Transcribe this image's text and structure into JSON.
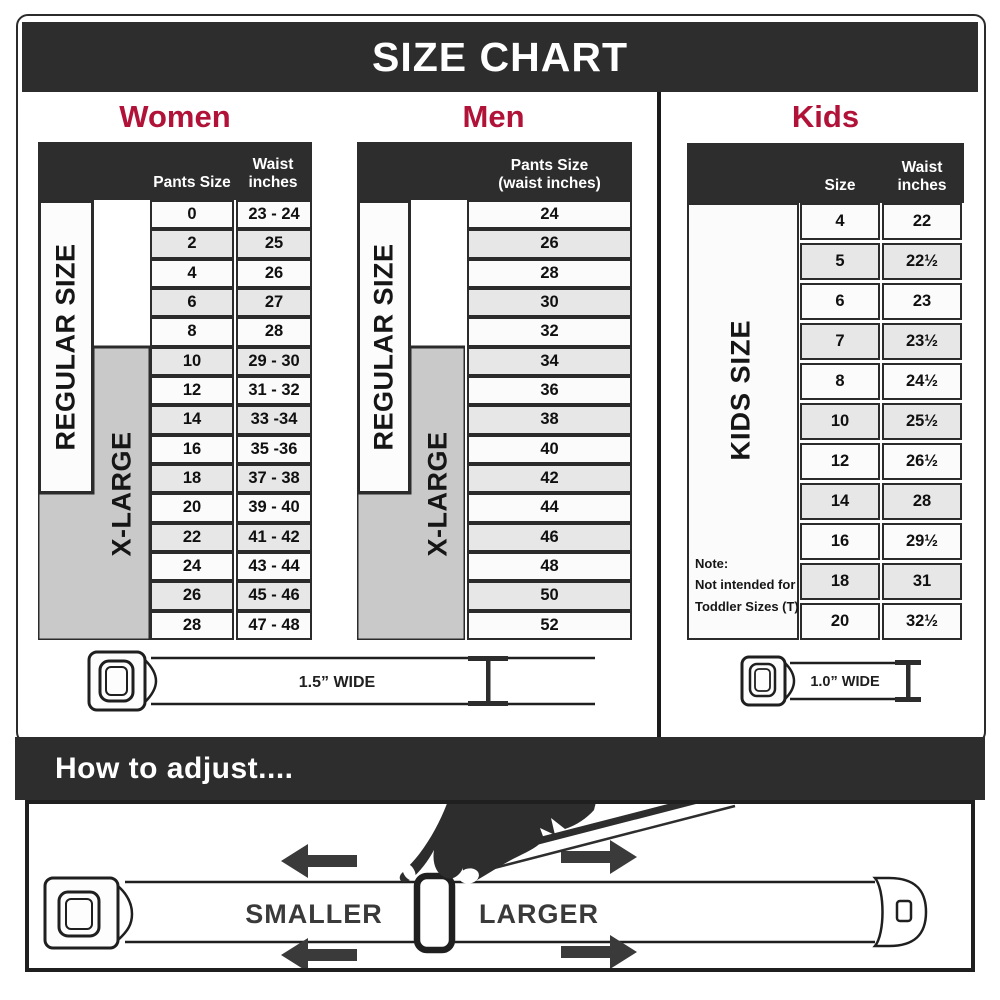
{
  "title": "SIZE CHART",
  "colors": {
    "banner_dark": "#2d2d2d",
    "accent_red": "#b11238",
    "row_shade": "#e7e7e7",
    "xlarge_gray": "#c9c9c9"
  },
  "women": {
    "heading": "Women",
    "col1_header": "Pants Size",
    "col2_header_line1": "Waist",
    "col2_header_line2": "inches",
    "regular_label": "REGULAR SIZE",
    "xlarge_label": "X-LARGE",
    "pants_sizes": [
      "0",
      "2",
      "4",
      "6",
      "8",
      "10",
      "12",
      "14",
      "16",
      "18",
      "20",
      "22",
      "24",
      "26",
      "28"
    ],
    "waist_inches": [
      "23 - 24",
      "25",
      "26",
      "27",
      "28",
      "29 - 30",
      "31 - 32",
      "33 -34",
      "35 -36",
      "37 - 38",
      "39 - 40",
      "41 - 42",
      "43 - 44",
      "45 - 46",
      "47 - 48"
    ],
    "belt_width_label": "1.5” WIDE"
  },
  "men": {
    "heading": "Men",
    "col_header_line1": "Pants Size",
    "col_header_line2": "(waist inches)",
    "regular_label": "REGULAR SIZE",
    "xlarge_label": "X-LARGE",
    "sizes": [
      "24",
      "26",
      "28",
      "30",
      "32",
      "34",
      "36",
      "38",
      "40",
      "42",
      "44",
      "46",
      "48",
      "50",
      "52"
    ]
  },
  "kids": {
    "heading": "Kids",
    "col1_header": "Size",
    "col2_header_line1": "Waist",
    "col2_header_line2": "inches",
    "label": "KIDS SIZE",
    "note_line1": "Note:",
    "note_line2": "Not intended for",
    "note_line3": "Toddler Sizes (T)",
    "sizes": [
      "4",
      "5",
      "6",
      "7",
      "8",
      "10",
      "12",
      "14",
      "16",
      "18",
      "20"
    ],
    "waist_inches": [
      "22",
      "22½",
      "23",
      "23½",
      "24½",
      "25½",
      "26½",
      "28",
      "29½",
      "31",
      "32½"
    ],
    "belt_width_label": "1.0” WIDE"
  },
  "adjust": {
    "heading": "How to adjust....",
    "smaller_label": "SMALLER",
    "larger_label": "LARGER"
  }
}
